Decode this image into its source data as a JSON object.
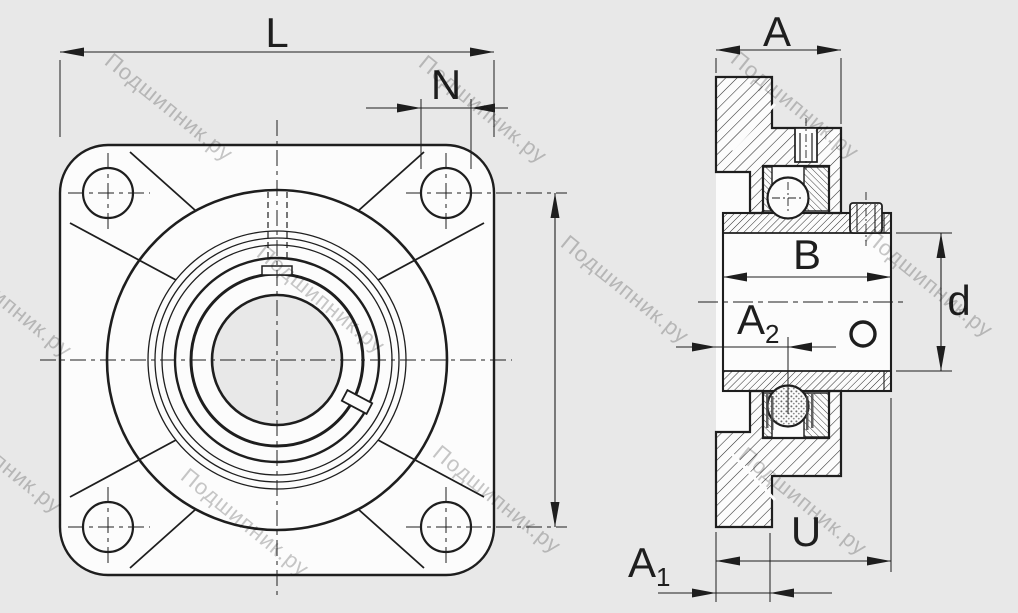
{
  "drawing": {
    "type": "bearing-unit-engineering-drawing",
    "views": {
      "front": "four-bolt-flanged-housing-front-view",
      "side": "flanged-unit-cross-section-side-view"
    }
  },
  "front_view": {
    "dims": {
      "overall_width": "L",
      "bolt_hole_diameter": "N"
    }
  },
  "side_view": {
    "dims": {
      "housing_depth": "A",
      "inner_ring_width": "B",
      "bore_diameter": "d",
      "face_to_center": {
        "base": "A",
        "sub": "2"
      },
      "face_to_step": {
        "base": "A",
        "sub": "1"
      },
      "total_width": "U"
    }
  },
  "watermark": {
    "text": "Подшипник.ру"
  },
  "colors": {
    "background": "#e8e8e8",
    "line": "#1e1e1e",
    "face": "#fcfcfc",
    "watermark": "#c2c2c2"
  }
}
